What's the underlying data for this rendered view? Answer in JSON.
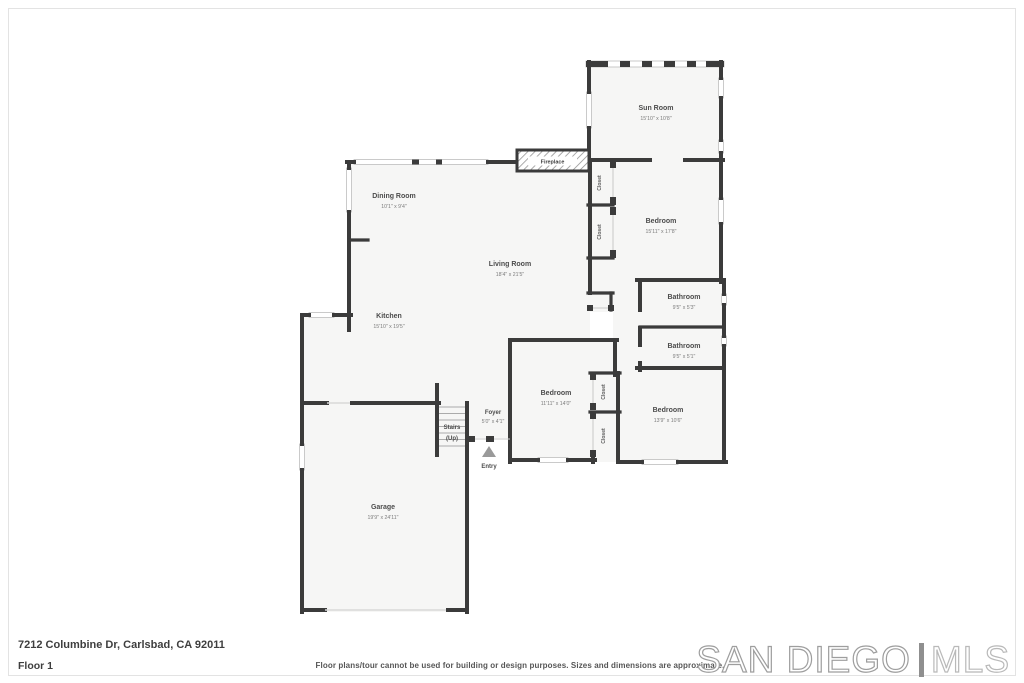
{
  "floorplan": {
    "wall_color": "#3b3b3b",
    "floor_color": "#f6f6f5",
    "rooms": {
      "sun_room": {
        "name": "Sun Room",
        "dims": "15'10\" x 10'8\""
      },
      "dining_room": {
        "name": "Dining Room",
        "dims": "10'1\" x 9'4\""
      },
      "living_room": {
        "name": "Living Room",
        "dims": "18'4\" x 21'5\""
      },
      "bedroom_1": {
        "name": "Bedroom",
        "dims": "15'11\" x 17'8\""
      },
      "bathroom_1": {
        "name": "Bathroom",
        "dims": "9'5\" x 5'3\""
      },
      "bathroom_2": {
        "name": "Bathroom",
        "dims": "9'5\" x 5'1\""
      },
      "kitchen": {
        "name": "Kitchen",
        "dims": "15'10\" x 19'5\""
      },
      "bedroom_2": {
        "name": "Bedroom",
        "dims": "11'11\" x 14'0\""
      },
      "bedroom_3": {
        "name": "Bedroom",
        "dims": "13'9\" x 10'6\""
      },
      "foyer": {
        "name": "Foyer",
        "dims": "5'0\" x 4'1\""
      },
      "garage": {
        "name": "Garage",
        "dims": "19'9\" x 24'11\""
      }
    },
    "features": {
      "fireplace": "Fireplace",
      "closet": "Closet",
      "stairs_line1": "Stairs",
      "stairs_line2": "(Up)",
      "entry": "Entry"
    }
  },
  "footer": {
    "address": "7212 Columbine Dr, Carlsbad, CA 92011",
    "floor_label": "Floor 1",
    "disclaimer": "Floor plans/tour cannot be used for building or design purposes. Sizes and dimensions are approximate."
  },
  "logo": {
    "primary": "SAN DIEGO",
    "secondary": "MLS"
  }
}
